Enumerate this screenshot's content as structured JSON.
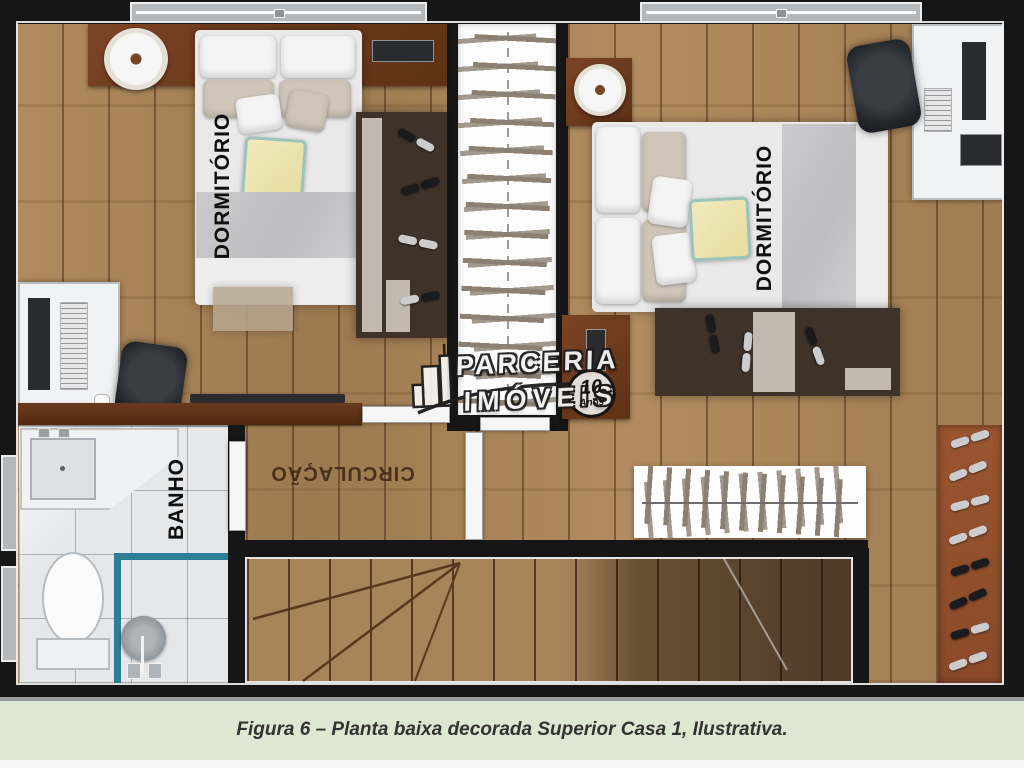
{
  "plan": {
    "rooms": {
      "bedroom_left_label": "DORMITÓRIO",
      "bedroom_right_label": "DORMITÓRIO",
      "bathroom_label": "BANHO",
      "hallway_label": "CIRCULAÇÃO"
    },
    "watermark": {
      "brand_line1": "PARCERIA",
      "brand_line2": "IMÓVEIS",
      "badge_number": "10",
      "badge_word": "Anos"
    },
    "colors": {
      "wood_floor": "#a8845a",
      "wall_black": "#161616",
      "interior_wall_brown": "#5f3319",
      "bathroom_tile": "#e5e7e9",
      "shower_glass_blue": "#2c7d95",
      "furniture_brown": "#6e3d20",
      "rug_dark_brown": "#3f3229",
      "shoe_rack_terracotta": "#95512e",
      "caption_background": "#dce8d1"
    }
  },
  "caption": {
    "text": "Figura 6 – Planta baixa decorada Superior Casa 1, Ilustrativa."
  }
}
